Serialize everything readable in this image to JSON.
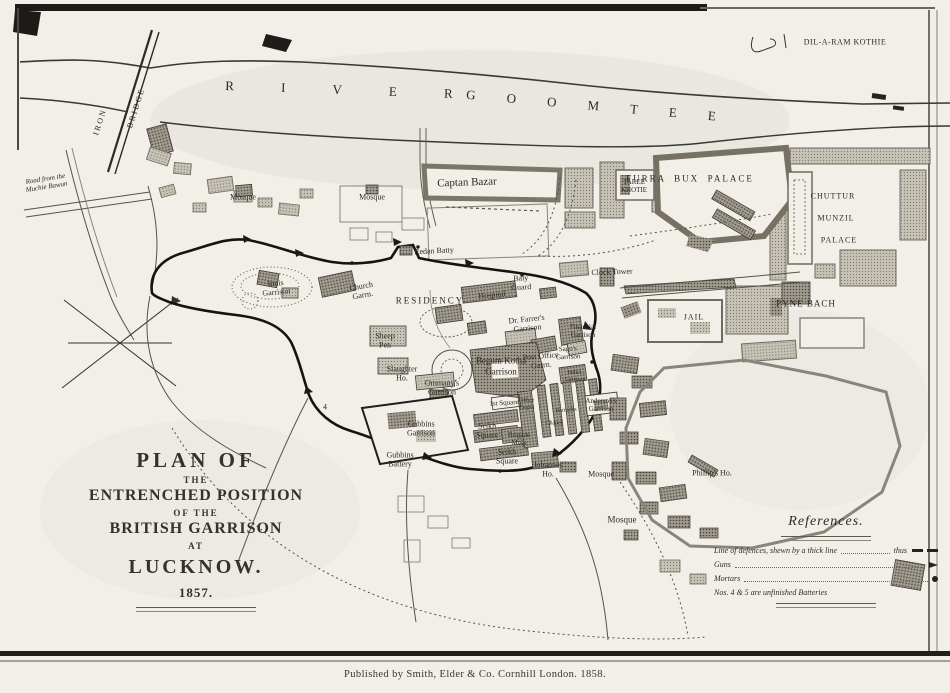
{
  "title_block": {
    "line1": "PLAN OF",
    "line2": "THE",
    "line3": "ENTRENCHED POSITION",
    "line4": "OF THE",
    "line5": "BRITISH GARRISON",
    "line6": "AT",
    "line7": "LUCKNOW.",
    "line8": "1857."
  },
  "references": {
    "heading": "References.",
    "line_defences_label": "Line of defences, shewn by a thick line",
    "line_defences_thus": "thus",
    "guns_label": "Guns",
    "mortars_label": "Mortars",
    "note": "Nos. 4 & 5 are unfinished Batteries"
  },
  "publisher": {
    "text": "Published by Smith, Elder & Co. Cornhill London. 1858."
  },
  "colors": {
    "paper": "#f1efe8",
    "ink": "#2b2924",
    "block_fill": "#a8a396",
    "defence_line": "#151411"
  },
  "map_labels": [
    {
      "name": "label-dil-a-ram-kothie",
      "lines": [
        "DIL-A-RAM KOTHIE"
      ],
      "x": 845,
      "y": 42,
      "size": 8,
      "spacing": 0.5
    },
    {
      "name": "label-river",
      "lines": [
        "R I V E R"
      ],
      "x": 350,
      "y": 90,
      "size": 13,
      "rotate": 2,
      "spacing": 22
    },
    {
      "name": "label-goomtee",
      "lines": [
        "G O O M T E E"
      ],
      "x": 598,
      "y": 106,
      "size": 13,
      "rotate": 5,
      "spacing": 14
    },
    {
      "name": "label-iron",
      "lines": [
        "IRON"
      ],
      "x": 100,
      "y": 122,
      "size": 8,
      "rotate": -72,
      "spacing": 2
    },
    {
      "name": "label-bridge",
      "lines": [
        "BRIDGE"
      ],
      "x": 136,
      "y": 108,
      "size": 8,
      "rotate": -72,
      "spacing": 2
    },
    {
      "name": "label-road-muchie-bawun",
      "lines": [
        "Road from the",
        "Muchie Bawun"
      ],
      "x": 46,
      "y": 183,
      "size": 7,
      "rotate": -9,
      "italic": true
    },
    {
      "name": "label-mosque-1",
      "lines": [
        "Mosque"
      ],
      "x": 243,
      "y": 197,
      "size": 8
    },
    {
      "name": "label-mosque-2",
      "lines": [
        "Mosque"
      ],
      "x": 372,
      "y": 197,
      "size": 8
    },
    {
      "name": "label-captan-bazar",
      "lines": [
        "Captan Bazar"
      ],
      "x": 467,
      "y": 183,
      "size": 11,
      "rotate": -2
    },
    {
      "name": "label-taree-khotie",
      "lines": [
        "TAREE",
        "KHOTIE"
      ],
      "x": 634,
      "y": 186,
      "size": 7
    },
    {
      "name": "label-furra-bux-palace",
      "lines": [
        "FURRA  BUX  PALACE"
      ],
      "x": 690,
      "y": 179,
      "size": 9,
      "spacing": 2
    },
    {
      "name": "label-chuttur",
      "lines": [
        "CHUTTUR"
      ],
      "x": 833,
      "y": 196,
      "size": 8,
      "spacing": 1
    },
    {
      "name": "label-munzil",
      "lines": [
        "MUNZIL"
      ],
      "x": 836,
      "y": 218,
      "size": 8,
      "spacing": 1
    },
    {
      "name": "label-palace",
      "lines": [
        "PALACE"
      ],
      "x": 839,
      "y": 240,
      "size": 8,
      "spacing": 1
    },
    {
      "name": "label-redan-batty",
      "lines": [
        "Redan Batty"
      ],
      "x": 434,
      "y": 251,
      "size": 8,
      "rotate": -3
    },
    {
      "name": "label-clock-tower",
      "lines": [
        "Clock Tower"
      ],
      "x": 612,
      "y": 272,
      "size": 8,
      "rotate": -2
    },
    {
      "name": "label-pyne-bach",
      "lines": [
        "PYNE BACH"
      ],
      "x": 806,
      "y": 304,
      "size": 9,
      "spacing": 1
    },
    {
      "name": "label-jail",
      "lines": [
        "JAIL"
      ],
      "x": 694,
      "y": 317,
      "size": 8,
      "spacing": 1
    },
    {
      "name": "label-innis-garrison",
      "lines": [
        "Innis",
        "Garrison"
      ],
      "x": 276,
      "y": 288,
      "size": 8,
      "rotate": -5
    },
    {
      "name": "label-church-garrison",
      "lines": [
        "Church",
        "Garrn."
      ],
      "x": 362,
      "y": 291,
      "size": 8,
      "rotate": -10
    },
    {
      "name": "label-residency",
      "lines": [
        "RESIDENCY"
      ],
      "x": 430,
      "y": 301,
      "size": 9,
      "spacing": 2
    },
    {
      "name": "label-hospital",
      "lines": [
        "Hospital"
      ],
      "x": 492,
      "y": 295,
      "size": 8,
      "rotate": -6
    },
    {
      "name": "label-baly-guard",
      "lines": [
        "Baly",
        "Guard"
      ],
      "x": 521,
      "y": 283,
      "size": 8,
      "rotate": -3
    },
    {
      "name": "label-dr-farrers-garrison",
      "lines": [
        "Dr. Farrer's",
        "Garrison"
      ],
      "x": 527,
      "y": 324,
      "size": 8,
      "rotate": -6
    },
    {
      "name": "label-financial-garrison",
      "lines": [
        "Financial",
        "Garrison"
      ],
      "x": 583,
      "y": 331,
      "size": 7
    },
    {
      "name": "label-sheep-pen",
      "lines": [
        "Sheep",
        "Pen"
      ],
      "x": 385,
      "y": 341,
      "size": 8
    },
    {
      "name": "label-slaughter-ho",
      "lines": [
        "Slaughter",
        "Ho."
      ],
      "x": 402,
      "y": 374,
      "size": 8
    },
    {
      "name": "label-begum-kotha-garrison",
      "lines": [
        "Begum Kotha",
        "Garrison"
      ],
      "x": 501,
      "y": 366,
      "size": 9
    },
    {
      "name": "label-ommanys-garrison",
      "lines": [
        "Ommany's",
        "Garrison"
      ],
      "x": 442,
      "y": 388,
      "size": 8
    },
    {
      "name": "label-post-office-garrison",
      "lines": [
        "Post Office",
        "Garrn."
      ],
      "x": 541,
      "y": 361,
      "size": 8,
      "rotate": -5
    },
    {
      "name": "label-sagos-garrison",
      "lines": [
        "Sago's",
        "Garrison"
      ],
      "x": 568,
      "y": 353,
      "size": 7,
      "rotate": -3
    },
    {
      "name": "label-judicial-garrison",
      "lines": [
        "Judicl.",
        "Garrison"
      ],
      "x": 575,
      "y": 377,
      "size": 6
    },
    {
      "name": "label-1st-square",
      "lines": [
        "1st Square"
      ],
      "x": 504,
      "y": 403,
      "size": 7,
      "rotate": -4
    },
    {
      "name": "label-office-depot",
      "lines": [
        "Office",
        "Depot"
      ],
      "x": 527,
      "y": 405,
      "size": 6,
      "rotate": -4
    },
    {
      "name": "label-barracks",
      "lines": [
        "Barracks"
      ],
      "x": 566,
      "y": 411,
      "size": 6,
      "rotate": -4
    },
    {
      "name": "label-chapel",
      "lines": [
        "Chapel"
      ],
      "x": 554,
      "y": 424,
      "size": 6
    },
    {
      "name": "label-andersons-garrison",
      "lines": [
        "Anderson's",
        "Garrison"
      ],
      "x": 601,
      "y": 405,
      "size": 7
    },
    {
      "name": "label-brigade-mess",
      "lines": [
        "Brigade",
        "Mess"
      ],
      "x": 519,
      "y": 439,
      "size": 7
    },
    {
      "name": "label-seikh-square-1",
      "lines": [
        "Seikh",
        "Square"
      ],
      "x": 487,
      "y": 431,
      "size": 8
    },
    {
      "name": "label-seikh-square-2",
      "lines": [
        "Seikh",
        "Square"
      ],
      "x": 507,
      "y": 457,
      "size": 8
    },
    {
      "name": "label-gubbins-garrison",
      "lines": [
        "Gubbins",
        "Garrison"
      ],
      "x": 421,
      "y": 429,
      "size": 8
    },
    {
      "name": "label-gubbins-battery",
      "lines": [
        "Gubbins",
        "Battery"
      ],
      "x": 400,
      "y": 460,
      "size": 8
    },
    {
      "name": "label-johannes-ho",
      "lines": [
        "Johannes",
        "Ho."
      ],
      "x": 548,
      "y": 470,
      "size": 8
    },
    {
      "name": "label-mosque-3",
      "lines": [
        "Mosque"
      ],
      "x": 601,
      "y": 474,
      "size": 8
    },
    {
      "name": "label-phillips-ho",
      "lines": [
        "Phillip's Ho."
      ],
      "x": 712,
      "y": 473,
      "size": 8
    },
    {
      "name": "label-mosque-4",
      "lines": [
        "Mosque"
      ],
      "x": 622,
      "y": 520,
      "size": 9
    },
    {
      "name": "label-battery-no-4",
      "lines": [
        "4"
      ],
      "x": 325,
      "y": 407,
      "size": 8
    }
  ]
}
